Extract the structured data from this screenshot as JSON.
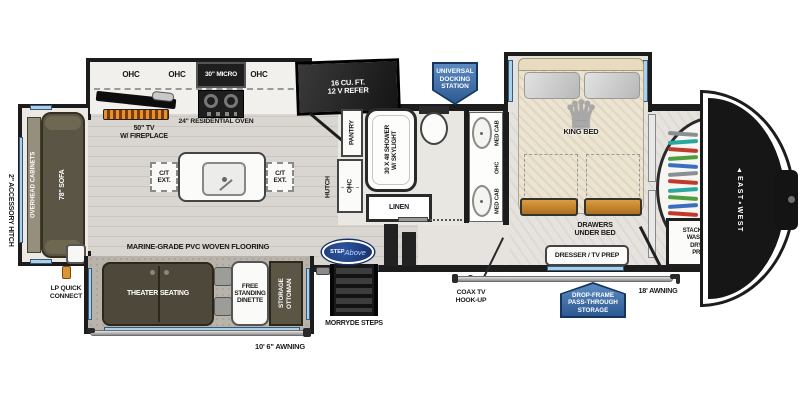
{
  "title": "Fifth wheel RV floor plan",
  "colors": {
    "badge_blue": "#2e5a94",
    "badge_navy": "#14365e",
    "window_blue": "#a9d0ea",
    "drawer_orange": "#c9862e",
    "flame_orange": "#e8912a",
    "logo_oval_navy": "#17306b",
    "furniture_olive": "#5b5545",
    "wall_black": "#1c1c1c"
  },
  "exterior": {
    "accessory_hitch": "2\" ACCESSORY HITCH",
    "lp_quick_connect": "LP QUICK\nCONNECT",
    "awning_main": "10' 6\" AWNING",
    "awning_front": "18' AWNING",
    "coax": "COAX TV\nHOOK-UP",
    "morryde_steps": "MORRYDE STEPS",
    "step_above_line1": "STEP",
    "step_above_line2": "Above",
    "docking_station": "UNIVERSAL\nDOCKING\nSTATION",
    "drop_frame": "DROP-FRAME\nPASS-THROUGH\nSTORAGE",
    "brand": "EAST∘WEST"
  },
  "living": {
    "overhead_cabinets": "OVERHEAD CABINETS",
    "sofa": "78\" SOFA",
    "ohc_labels": [
      "OHC",
      "OHC",
      "OHC"
    ],
    "micro": "30\" MICRO",
    "oven": "24\" RESIDENTIAL OVEN",
    "tv": "50\" TV\nW/ FIREPLACE",
    "refer": "16 CU. FT.\n12 V REFER",
    "ct_ext": "C/T\nEXT.",
    "flooring": "MARINE-GRADE PVC WOVEN FLOORING",
    "theater": "THEATER SEATING",
    "dinette": "FREE\nSTANDING\nDINETTE",
    "ottoman": "STORAGE\nOTTOMAN",
    "pantry": "PANTRY",
    "hutch": "HUTCH",
    "hutch_ohc": "OHC"
  },
  "bath": {
    "shower": "30 X 48 SHOWER\nW/ SKYLIGHT",
    "linen": "LINEN",
    "med_cab_top": "MED CAB",
    "ohc": "OHC",
    "med_cab_bottom": "MED CAB"
  },
  "bedroom": {
    "king_bed": "KING BED",
    "drawers": "DRAWERS\nUNDER BED",
    "dresser": "DRESSER / TV PREP",
    "stackable": "STACKABLE\nWASHER/\nDRYER\nPREP"
  },
  "closet": {
    "hanger_colors": [
      "#8a8f93",
      "#2aa7a0",
      "#c0392b",
      "#4f9e3c",
      "#3a6fc0",
      "#8a8f93",
      "#c0392b",
      "#2aa7a0",
      "#4f9e3c",
      "#3a6fc0",
      "#c0392b",
      "#8a8f93",
      "#4f9e3c",
      "#3a6fc0"
    ]
  }
}
